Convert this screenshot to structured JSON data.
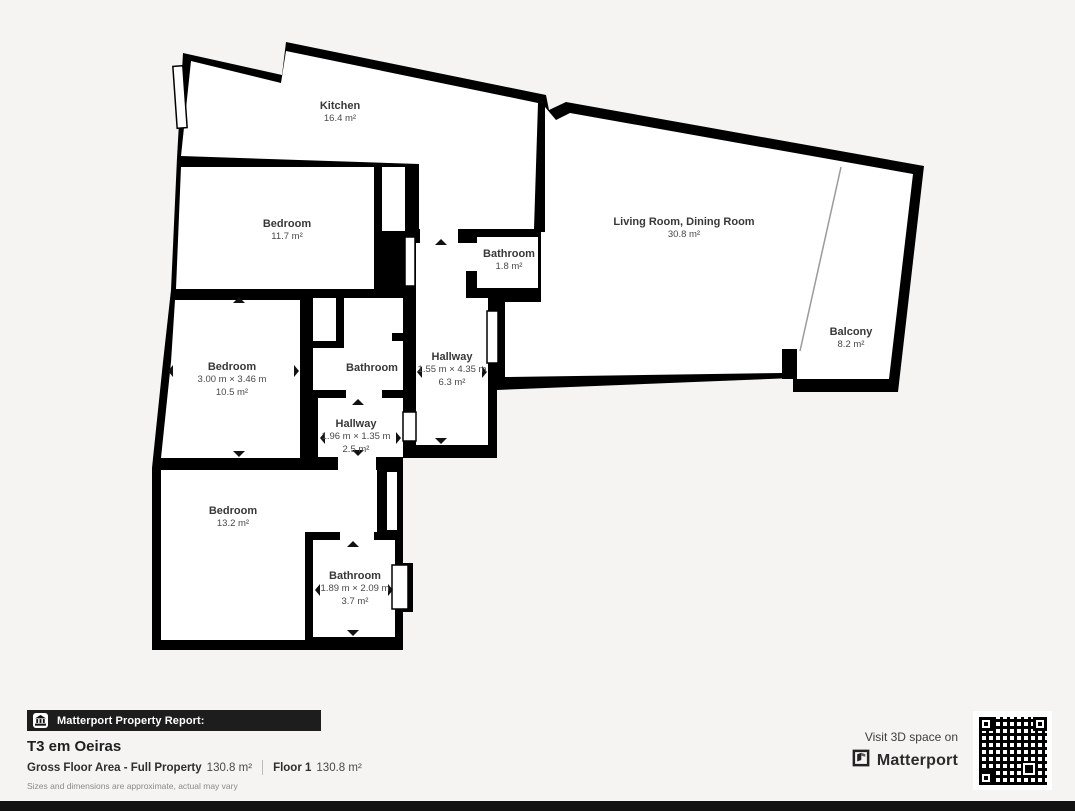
{
  "plan": {
    "wall_color": "#000000",
    "background": "#f5f4f2",
    "rooms": [
      {
        "name": "Kitchen",
        "area": "16.4 m²"
      },
      {
        "name": "Bedroom",
        "area": "11.7 m²"
      },
      {
        "name": "Bathroom",
        "area": "1.8 m²"
      },
      {
        "name": "Living Room, Dining Room",
        "area": "30.8 m²"
      },
      {
        "name": "Balcony",
        "area": "8.2 m²"
      },
      {
        "name": "Bedroom",
        "dims": "3.00 m × 3.46 m",
        "area": "10.5 m²"
      },
      {
        "name": "Bathroom"
      },
      {
        "name": "Hallway",
        "dims": "1.55 m × 4.35 m",
        "area": "6.3 m²"
      },
      {
        "name": "Hallway",
        "dims": "1.96 m × 1.35 m",
        "area": "2.5 m²"
      },
      {
        "name": "Bedroom",
        "area": "13.2 m²"
      },
      {
        "name": "Bathroom",
        "dims": "1.89 m × 2.09 m",
        "area": "3.7 m²"
      }
    ]
  },
  "footer": {
    "badge_label": "Matterport Property Report:",
    "title": "T3 em Oeiras",
    "gross_label": "Gross Floor Area - Full Property",
    "gross_value": "130.8 m²",
    "floor_label": "Floor 1",
    "floor_value": "130.8 m²",
    "disclaimer": "Sizes and dimensions are approximate, actual may vary"
  },
  "cta": {
    "line": "Visit 3D space on",
    "brand": "Matterport"
  },
  "icons": {
    "badge": "building-icon",
    "brand": "matterport-mark-icon",
    "qr": "qr-code"
  }
}
